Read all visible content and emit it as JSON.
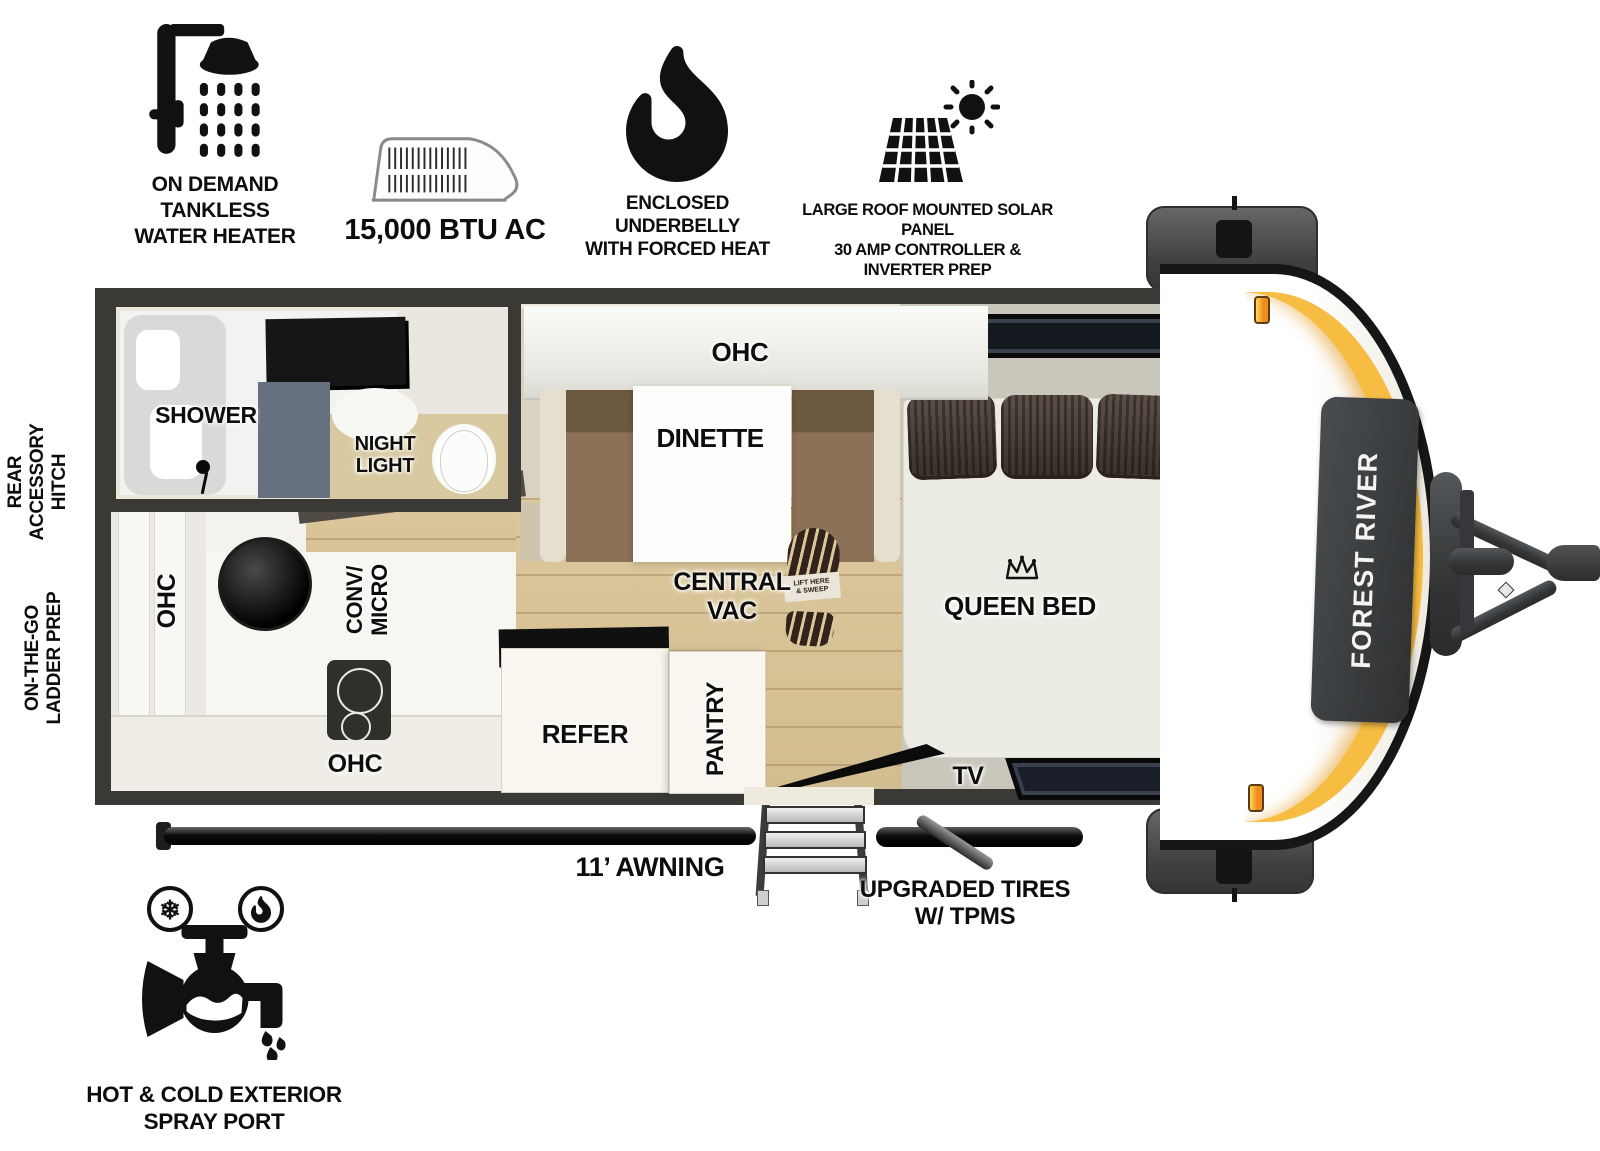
{
  "trailer": {
    "brand": "FOREST RIVER"
  },
  "top_features": {
    "water_heater": {
      "icon": "shower-head-icon",
      "line1": "ON DEMAND",
      "line2": "TANKLESS",
      "line3": "WATER HEATER"
    },
    "ac": {
      "icon": "rooftop-ac-icon",
      "label": "15,000 BTU AC"
    },
    "underbelly": {
      "icon": "flame-icon",
      "line1": "ENCLOSED UNDERBELLY",
      "line2": "WITH FORCED HEAT"
    },
    "solar": {
      "icon": "solar-panel-icon",
      "line1": "LARGE ROOF MOUNTED SOLAR PANEL",
      "line2": "30 AMP CONTROLLER & INVERTER PREP"
    }
  },
  "side_features": {
    "rear_hitch": {
      "line1": "REAR",
      "line2": "ACCESSORY",
      "line3": "HITCH"
    },
    "ladder": {
      "line1": "ON-THE-GO",
      "line2": "LADDER PREP"
    }
  },
  "plan": {
    "bathroom": {
      "shower": "SHOWER",
      "night_light": {
        "line1": "NIGHT",
        "line2": "LIGHT"
      }
    },
    "dinette_area": {
      "ohc": "OHC",
      "dinette": "DINETTE"
    },
    "bed": {
      "label": "QUEEN BED",
      "tv": "TV"
    },
    "central_vac": {
      "line1": "CENTRAL",
      "line2": "VAC",
      "boot_note": {
        "line1": "LIFT HERE",
        "line2": "& SWEEP"
      }
    },
    "kitchen": {
      "ohc_left": "OHC",
      "conv_micro": {
        "line1": "CONV/",
        "line2": "MICRO"
      },
      "ohc_bottom": "OHC",
      "refer": "REFER",
      "pantry": "PANTRY"
    }
  },
  "bottom_features": {
    "awning": {
      "label": "11’ AWNING"
    },
    "tires": {
      "line1": "UPGRADED TIRES",
      "line2": "W/ TPMS"
    },
    "spray_port": {
      "icon": "hot-cold-spray-port-icon",
      "line1": "HOT & COLD EXTERIOR",
      "line2": "SPRAY PORT"
    }
  },
  "colors": {
    "wall": "#3a3936",
    "interior_trim": "#ebe7d8",
    "wood_floor": "#d7c69b",
    "bench_brown": "#8a7158",
    "accent_gold": "#f6b93f",
    "marker_light_orange": "#f59b1e",
    "label_text": "#0d0d0d"
  }
}
